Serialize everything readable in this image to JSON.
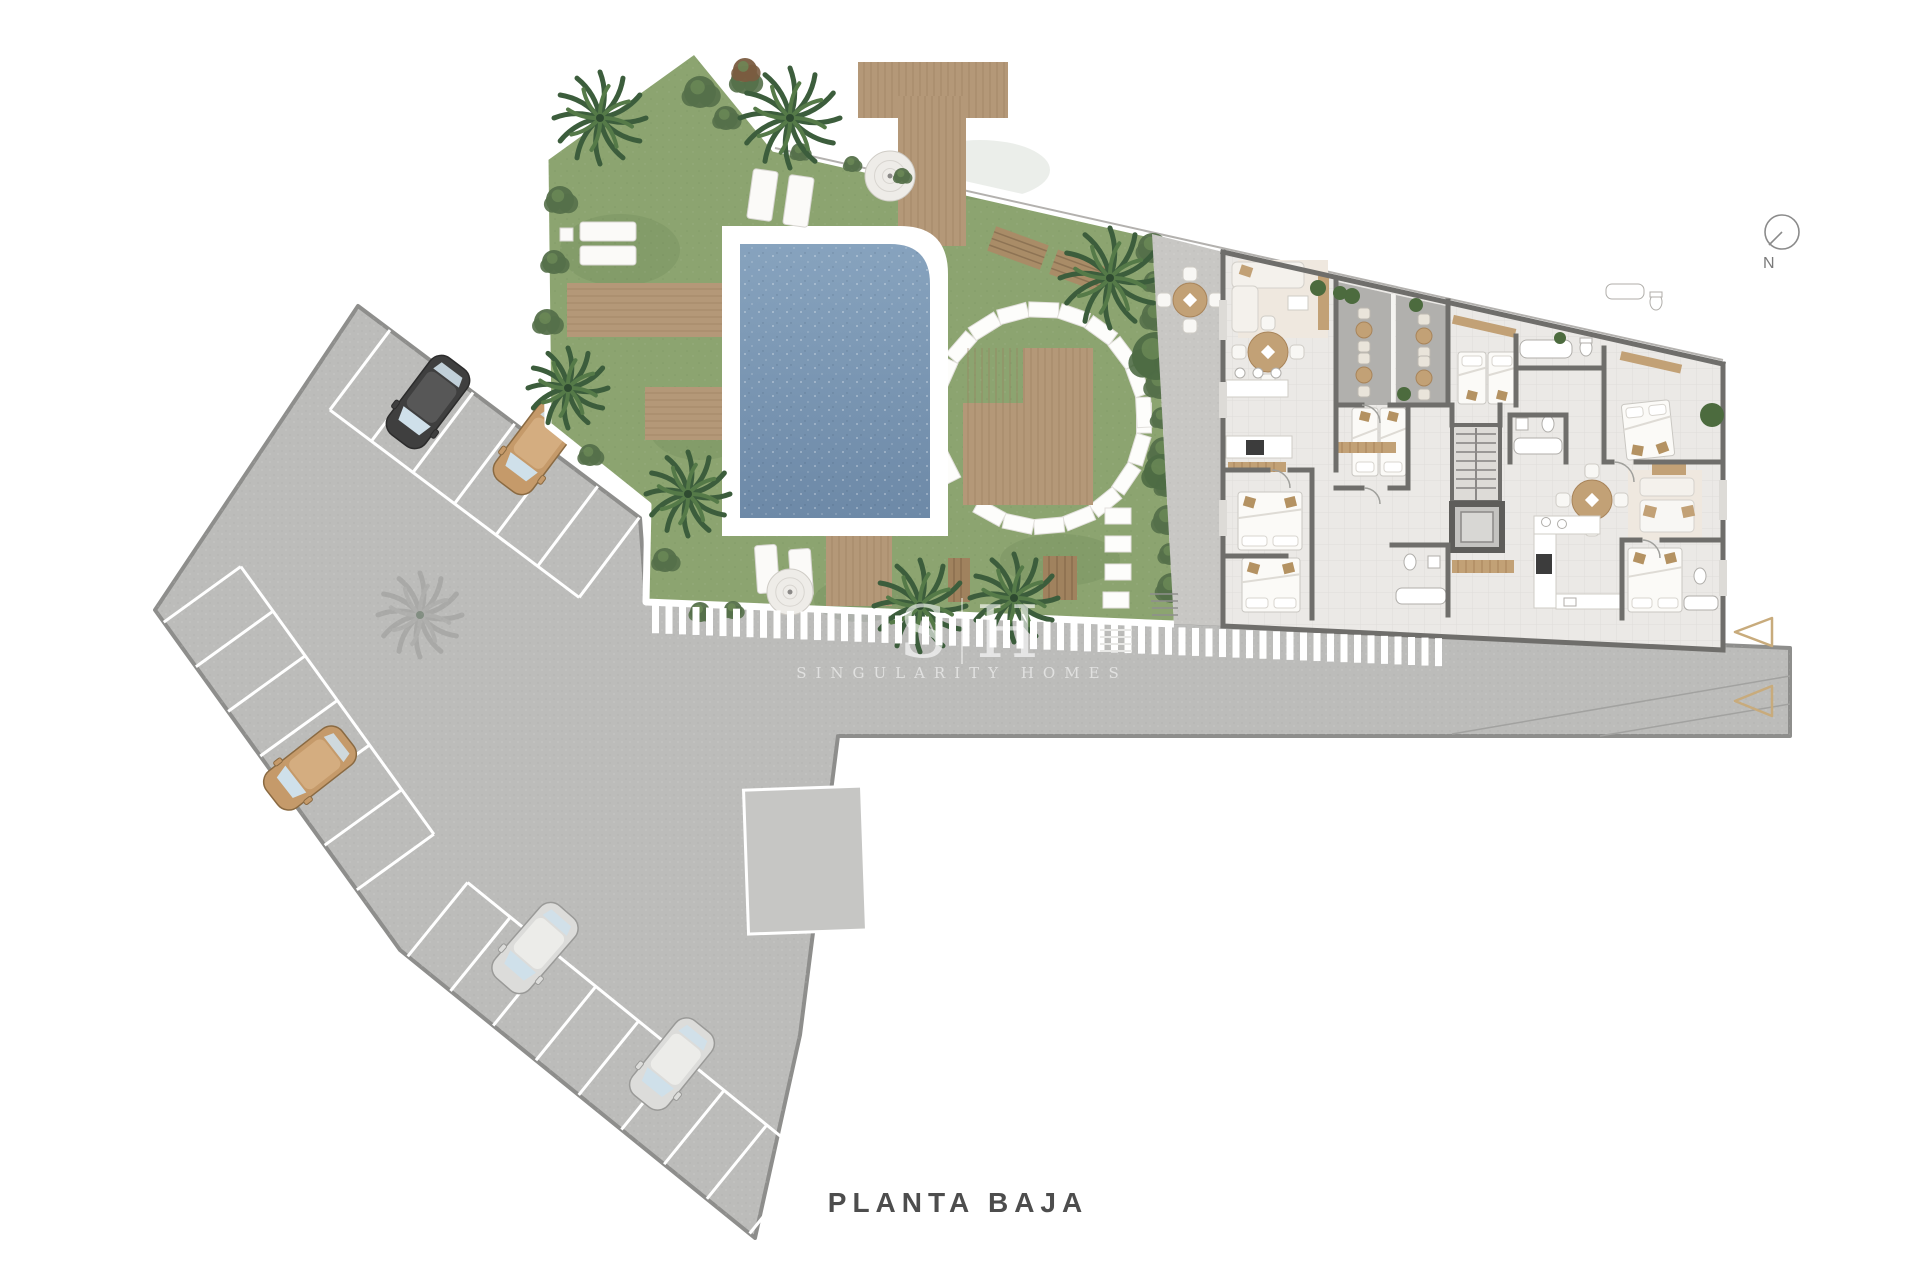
{
  "title": {
    "label": "PLANTA BAJA"
  },
  "compass": {
    "label": "N"
  },
  "watermark": {
    "left_initial": "S",
    "right_initial": "H",
    "name": "SINGULARITY HOMES"
  },
  "colors": {
    "background": "#ffffff",
    "asphalt": "#bcbcba",
    "asphalt_light": "#c6c6c4",
    "curb": "#8e8e8c",
    "marking": "#ffffff",
    "grass": "#8ca470",
    "grass_dark": "#768c5d",
    "hedge": "#55704a",
    "palm_dark": "#3c5d3c",
    "palm_light": "#557a48",
    "pool_water_top": "#87a3be",
    "pool_water_bottom": "#6d89a7",
    "pool_deck": "#ffffff",
    "wood": "#b49878",
    "wood_line": "#997e5f",
    "floor": "#ebe9e6",
    "wall": "#6f6e6b",
    "terrace": "#c8c7c4",
    "patio": "#b1b0ad",
    "furniture_white": "#f8f7f4",
    "furniture_cream": "#efe8df",
    "tan": "#c2a176",
    "appliance_dark": "#3c3c3c",
    "fixture_stroke": "#b0aeaa",
    "triangle_marker": "#c8ab7c",
    "compass_stroke": "#8b8b8b",
    "title_text": "#4d4d4d",
    "watermark_text": "rgba(255,255,255,0.62)"
  },
  "parking": {
    "car_count": 5,
    "cars": [
      {
        "name": "car-black",
        "color_key": "black",
        "x": 428,
        "y": 402,
        "rot": 217
      },
      {
        "name": "car-tan-top",
        "color_key": "tan",
        "x": 535,
        "y": 448,
        "rot": 217
      },
      {
        "name": "car-tan-mid",
        "color_key": "tan",
        "x": 310,
        "y": 768,
        "rot": 232
      },
      {
        "name": "car-silver-1",
        "color_key": "silver",
        "x": 535,
        "y": 948,
        "rot": 221
      },
      {
        "name": "car-silver-2",
        "color_key": "silver",
        "x": 672,
        "y": 1064,
        "rot": 219
      }
    ],
    "car_colors": {
      "black": {
        "body": "#3f3f3f",
        "roof": "#575757",
        "stroke": "#2c2c2c"
      },
      "tan": {
        "body": "#c59a6a",
        "roof": "#d4ad80",
        "stroke": "#8a6a42"
      },
      "silver": {
        "body": "#dcdcda",
        "roof": "#ecece9",
        "stroke": "#9a9a98"
      }
    }
  },
  "garden": {
    "features": [
      "pool",
      "wood-decks",
      "palm-trees",
      "stepping-stone-ring",
      "sun-loungers",
      "parasols",
      "planter",
      "hedge"
    ],
    "palms": [
      {
        "x": 600,
        "y": 118,
        "r": 46
      },
      {
        "x": 790,
        "y": 118,
        "r": 50
      },
      {
        "x": 568,
        "y": 388,
        "r": 40
      },
      {
        "x": 688,
        "y": 494,
        "r": 42
      },
      {
        "x": 920,
        "y": 606,
        "r": 46
      },
      {
        "x": 1014,
        "y": 598,
        "r": 44
      },
      {
        "x": 1110,
        "y": 278,
        "r": 50
      }
    ],
    "parasols": [
      {
        "x": 890,
        "y": 176,
        "r": 25
      },
      {
        "x": 790,
        "y": 592,
        "r": 23
      }
    ]
  },
  "markers": {
    "triangle_count": 2
  }
}
